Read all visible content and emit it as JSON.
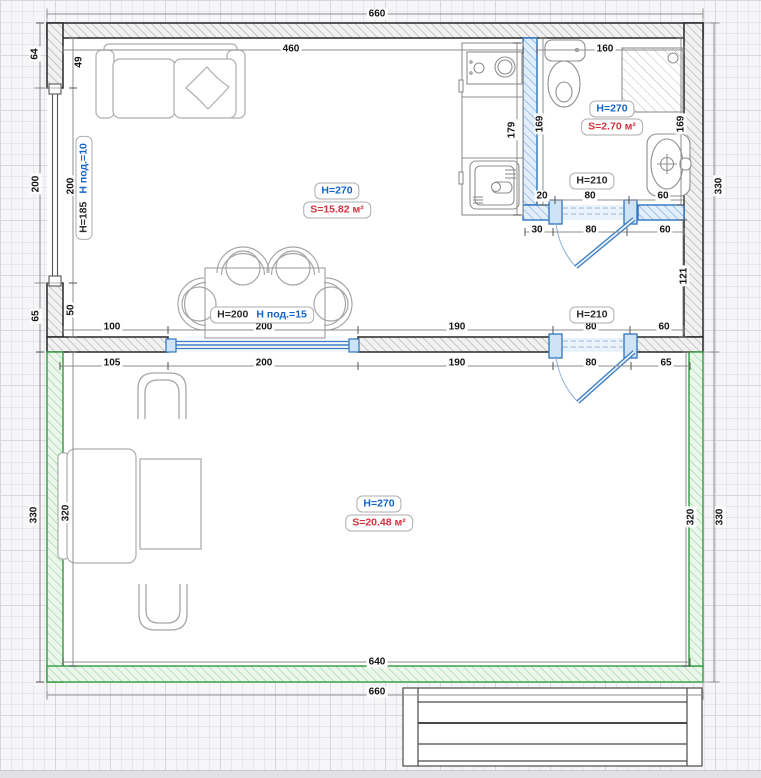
{
  "plan": {
    "rooms": {
      "living_kitchen": {
        "height_label": "H=270",
        "area_label": "S=15.82 м²"
      },
      "bathroom": {
        "height_label": "H=270",
        "area_label": "S=2.70 м²"
      },
      "veranda": {
        "height_label": "H=270",
        "area_label": "S=20.48 м²"
      }
    },
    "openings": {
      "bathroom_door": {
        "label": "H=210"
      },
      "room_door": {
        "label": "H=210"
      },
      "inner_window": {
        "height_label": "H=200",
        "sill_label": "H под.=15"
      },
      "left_window": {
        "height_label": "H=185",
        "sill_label": "H под.=10"
      }
    },
    "dimensions": [
      {
        "text": "660",
        "x": 377,
        "y": 14,
        "rot": 0
      },
      {
        "text": "460",
        "x": 291,
        "y": 49,
        "rot": 0
      },
      {
        "text": "160",
        "x": 605,
        "y": 49,
        "rot": 0
      },
      {
        "text": "640",
        "x": 377,
        "y": 662,
        "rot": 0
      },
      {
        "text": "660",
        "x": 377,
        "y": 692,
        "rot": 0
      },
      {
        "text": "64",
        "x": 35,
        "y": 54,
        "rot": 1
      },
      {
        "text": "49",
        "x": 79,
        "y": 62,
        "rot": 1
      },
      {
        "text": "200",
        "x": 36,
        "y": 184,
        "rot": 1
      },
      {
        "text": "200",
        "x": 71,
        "y": 186,
        "rot": 1
      },
      {
        "text": "65",
        "x": 36,
        "y": 316,
        "rot": 1
      },
      {
        "text": "50",
        "x": 71,
        "y": 310,
        "rot": 1
      },
      {
        "text": "330",
        "x": 719,
        "y": 186,
        "rot": 1
      },
      {
        "text": "330",
        "x": 34,
        "y": 515,
        "rot": 1
      },
      {
        "text": "320",
        "x": 66,
        "y": 513,
        "rot": 1
      },
      {
        "text": "320",
        "x": 691,
        "y": 517,
        "rot": 1
      },
      {
        "text": "330",
        "x": 720,
        "y": 517,
        "rot": 1
      },
      {
        "text": "179",
        "x": 512,
        "y": 130,
        "rot": 1
      },
      {
        "text": "169",
        "x": 540,
        "y": 124,
        "rot": 1
      },
      {
        "text": "169",
        "x": 681,
        "y": 124,
        "rot": 1
      },
      {
        "text": "121",
        "x": 684,
        "y": 276,
        "rot": 1
      },
      {
        "text": "20",
        "x": 542,
        "y": 196,
        "rot": 0
      },
      {
        "text": "80",
        "x": 590,
        "y": 196,
        "rot": 0
      },
      {
        "text": "60",
        "x": 663,
        "y": 196,
        "rot": 0
      },
      {
        "text": "30",
        "x": 537,
        "y": 230,
        "rot": 0
      },
      {
        "text": "80",
        "x": 591,
        "y": 230,
        "rot": 0
      },
      {
        "text": "60",
        "x": 665,
        "y": 230,
        "rot": 0
      },
      {
        "text": "100",
        "x": 112,
        "y": 327,
        "rot": 0
      },
      {
        "text": "200",
        "x": 264,
        "y": 327,
        "rot": 0
      },
      {
        "text": "190",
        "x": 457,
        "y": 327,
        "rot": 0
      },
      {
        "text": "80",
        "x": 591,
        "y": 327,
        "rot": 0
      },
      {
        "text": "60",
        "x": 664,
        "y": 327,
        "rot": 0
      },
      {
        "text": "105",
        "x": 112,
        "y": 363,
        "rot": 0
      },
      {
        "text": "200",
        "x": 264,
        "y": 363,
        "rot": 0
      },
      {
        "text": "190",
        "x": 457,
        "y": 363,
        "rot": 0
      },
      {
        "text": "80",
        "x": 591,
        "y": 363,
        "rot": 0
      },
      {
        "text": "65",
        "x": 666,
        "y": 363,
        "rot": 0
      }
    ]
  },
  "colors": {
    "height_label": "#1464c8",
    "area_label": "#d2323e",
    "new_wall_blue": "#2e74c0",
    "veranda_wall_green": "#3da04b",
    "dimension_text": "#151515"
  }
}
